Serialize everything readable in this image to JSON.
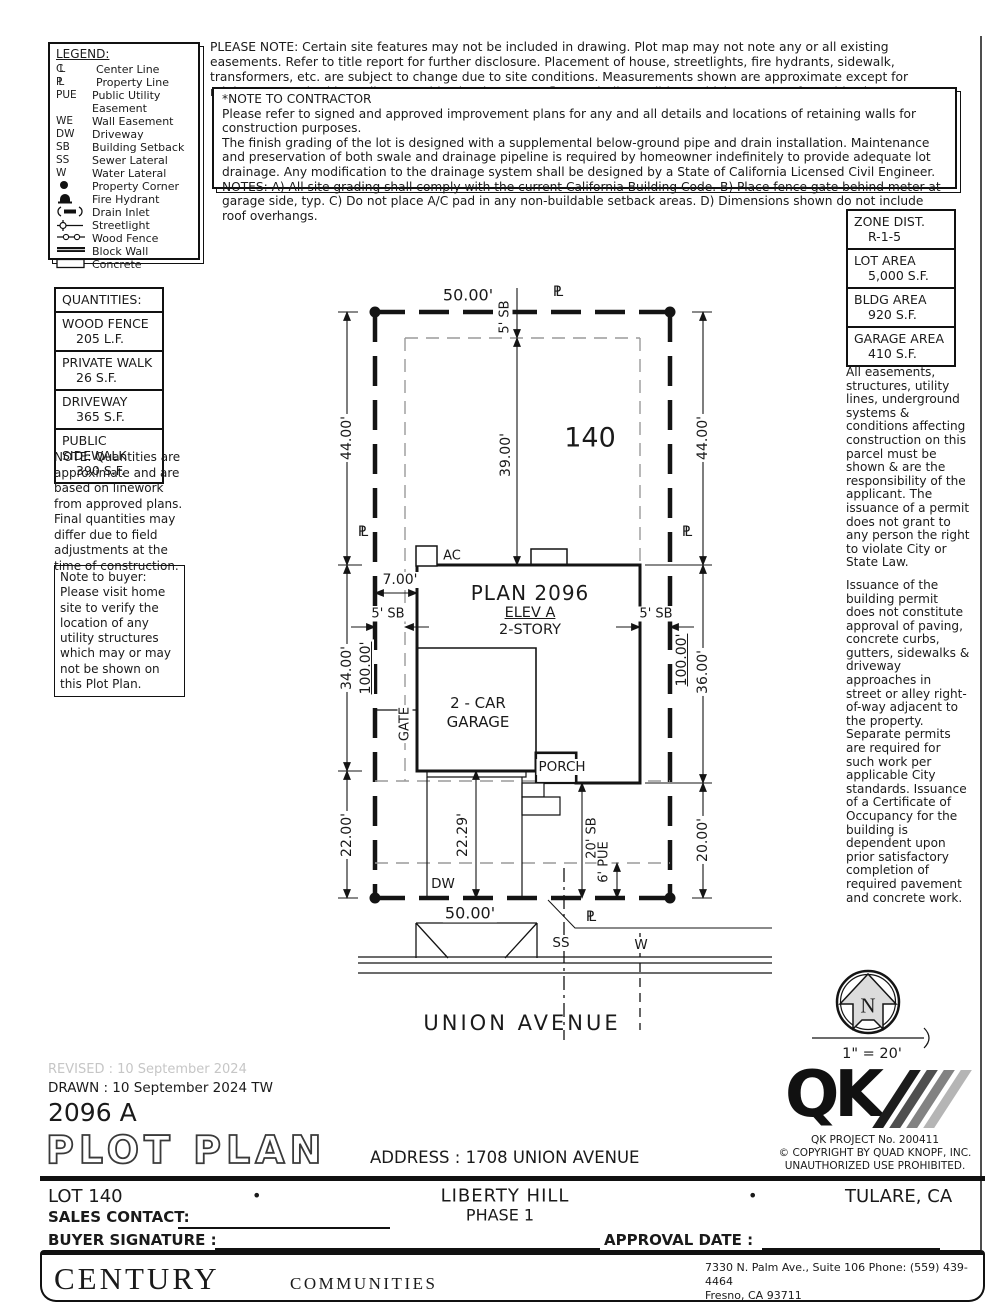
{
  "notes": {
    "please_note": "PLEASE NOTE:  Certain site features may not be included in drawing.  Plot map may not note any or all existing easements. Refer to title report for further disclosure.  Placement of house, streetlights, fire hydrants, sidewalk, transformers, etc. are subject to change due to site conditions.  Measurements shown are approximate except for minimums required by ordinance.  This plot does not reflect as-built conditions which may vary from this plan.",
    "contractor_title": "*NOTE TO CONTRACTOR",
    "contractor_p1": "Please refer to signed and approved improvement plans for any and all details and locations of retaining walls for construction purposes.",
    "contractor_p2": "The finish grading of the lot is designed with a supplemental below-ground pipe and drain installation.  Maintenance and preservation of both swale and drainage pipeline is required by homeowner indefinitely to provide adequate lot drainage.  Any modification to the drainage system shall be designed by a State of California Licensed Civil Engineer.",
    "contractor_p3": "NOTES:  A) All site grading shall comply with the current California Building Code.  B) Place fence gate behind meter at garage side, typ.  C) Do not place A/C pad in any non-buildable setback areas.  D) Dimensions shown do not include roof overhangs.",
    "quantities_note": "NOTE: Quantities are approximate and are based on linework from approved plans.  Final quantities may differ due to field adjustments at the time of construction.",
    "buyer_note": "Note to buyer:  Please visit home site to verify the location of any utility structures which may or may not be shown on this Plot Plan.",
    "right_p1": "All easements, structures, utility lines, underground systems & conditions affecting construction on this parcel must be shown & are the responsibility of the applicant. The issuance of a permit does not grant to any person the right to violate City or State Law.",
    "right_p2": "Issuance of the building permit does not constitute approval of paving, concrete curbs, gutters, sidewalks & driveway approaches in street or alley right-of-way adjacent to the property. Separate permits are required for such work per applicable City standards. Issuance of a Certificate of Occupancy for the building is dependent upon prior satisfactory completion of required pavement and concrete work."
  },
  "legend": {
    "title": "LEGEND:",
    "items": [
      {
        "symbol": "CL",
        "label": "Center Line"
      },
      {
        "symbol": "PL",
        "label": "Property Line"
      },
      {
        "symbol": "PUE",
        "label": "Public Utility Easement"
      },
      {
        "symbol": "WE",
        "label": "Wall Easement"
      },
      {
        "symbol": "DW",
        "label": "Driveway"
      },
      {
        "symbol": "SB",
        "label": "Building Setback"
      },
      {
        "symbol": "SS",
        "label": "Sewer Lateral"
      },
      {
        "symbol": "W",
        "label": "Water Lateral"
      },
      {
        "symbol": "",
        "label": "Property Corner"
      },
      {
        "symbol": "",
        "label": "Fire Hydrant"
      },
      {
        "symbol": "",
        "label": "Drain Inlet"
      },
      {
        "symbol": "",
        "label": "Streetlight"
      },
      {
        "symbol": "",
        "label": "Wood Fence"
      },
      {
        "symbol": "",
        "label": "Block Wall"
      },
      {
        "symbol": "",
        "label": "Concrete"
      }
    ]
  },
  "zone_table": {
    "rows": [
      {
        "label": "ZONE DIST.",
        "value": "R-1-5"
      },
      {
        "label": "LOT AREA",
        "value": "5,000 S.F."
      },
      {
        "label": "BLDG AREA",
        "value": "920 S.F."
      },
      {
        "label": "GARAGE AREA",
        "value": "410 S.F."
      }
    ]
  },
  "quantities": {
    "title": "QUANTITIES:",
    "rows": [
      {
        "label": "WOOD FENCE",
        "value": "205 L.F."
      },
      {
        "label": "PRIVATE WALK",
        "value": "26 S.F."
      },
      {
        "label": "DRIVEWAY",
        "value": "365 S.F."
      },
      {
        "label": "PUBLIC SIDEWALK",
        "value": "390 S.F."
      }
    ]
  },
  "plot": {
    "dim_top": "50.00'",
    "dim_bottom": "50.00'",
    "pl": "PL",
    "sb5_top": "5' SB",
    "dim_39": "39.00'",
    "lot_number": "140",
    "dim_44_left": "44.00'",
    "dim_44_right": "44.00'",
    "dim_34": "34.00'",
    "dim_100_left": "100.00'",
    "dim_100_right": "100.00'",
    "dim_36": "36.00'",
    "dim_22": "22.00'",
    "dim_2229": "22.29'",
    "dim_20": "20.00'",
    "sb5_left": "5' SB",
    "sb5_right": "5' SB",
    "sb20": "20' SB",
    "pue6": "6' PUE",
    "dim_7": "7.00'",
    "plan_name": "PLAN 2096",
    "elev": "ELEV A",
    "story": "2-STORY",
    "garage_line1": "2 - CAR",
    "garage_line2": "GARAGE",
    "gate": "GATE",
    "porch": "PORCH",
    "ac": "AC",
    "dw": "DW",
    "ss": "SS",
    "w": "W",
    "street": "UNION AVENUE",
    "north": "N",
    "scale": "1\" = 20'"
  },
  "title_block": {
    "revised": "REVISED :  10 September 2024",
    "drawn": "DRAWN :  10 September 2024   TW",
    "plan_code": "2096 A",
    "title": "PLOT PLAN",
    "address": "ADDRESS :   1708 UNION AVENUE",
    "lot": "LOT 140",
    "bullet": "•",
    "community": "LIBERTY HILL",
    "phase": "PHASE 1",
    "city": "TULARE, CA",
    "sales_contact": "SALES CONTACT:",
    "buyer_signature": "BUYER SIGNATURE :",
    "approval_date": "APPROVAL DATE :"
  },
  "qk": {
    "logo": "QK",
    "project": "QK PROJECT No. 200411",
    "copyright": "©   COPYRIGHT BY QUAD KNOPF, INC.",
    "prohibited": "UNAUTHORIZED USE PROHIBITED."
  },
  "footer": {
    "brand_main": "CENTURY",
    "brand_sub": "COMMUNITIES",
    "addr1": "7330 N. Palm Ave., Suite 106    Phone:  (559) 439-4464",
    "addr2": "Fresno, CA  93711"
  },
  "colors": {
    "line": "#141414",
    "setback": "#9a9a9a",
    "faint": "#c6c6c6"
  }
}
